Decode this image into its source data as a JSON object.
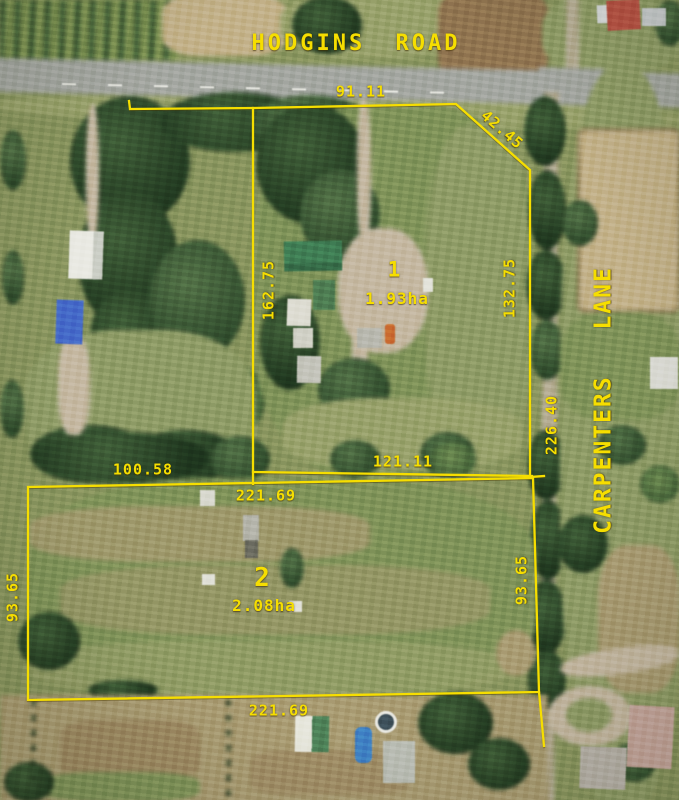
{
  "roads": {
    "hodgins_road": "HODGINS ROAD",
    "carpenters_lane": "CARPENTERS LANE"
  },
  "lots": {
    "lot1": {
      "number": "1",
      "area": "1.93ha",
      "north_frontage_m": "91.11",
      "northeast_splay_m": "42.45",
      "west_side_m": "162.75",
      "east_side_m": "132.75",
      "south_side_m": "121.11"
    },
    "lot2": {
      "number": "2",
      "area": "2.08ha",
      "north_side_total_m": "221.69",
      "north_side_west_segment_m": "100.58",
      "west_side_m": "93.65",
      "east_side_m": "93.65",
      "south_side_m": "221.69"
    },
    "combined_lane_frontage_m": "226.40"
  },
  "colors": {
    "boundary": "#f6de00"
  }
}
